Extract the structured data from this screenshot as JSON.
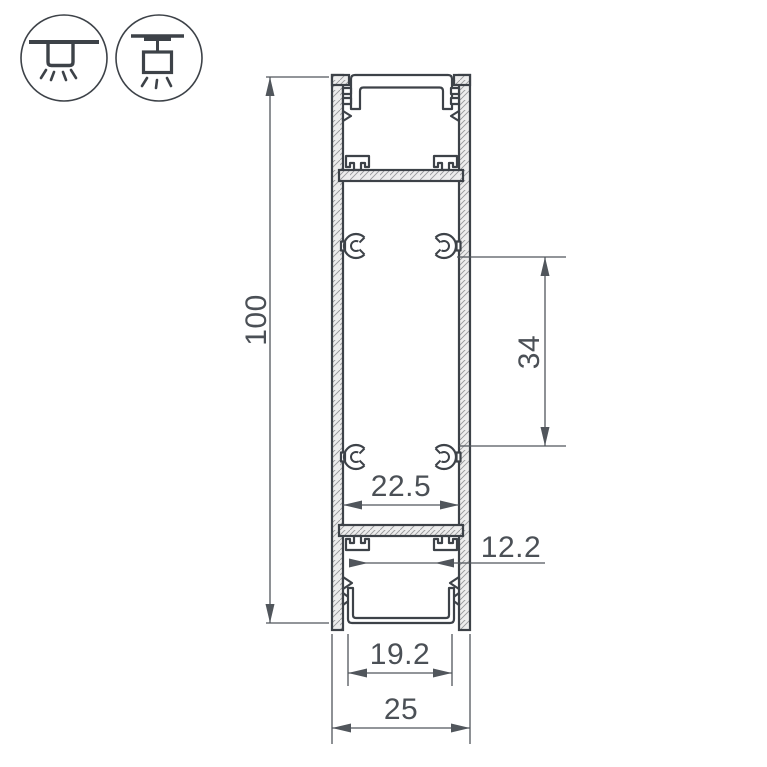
{
  "drawing": {
    "dimensions": {
      "overall_height": "100",
      "boss_spacing": "34",
      "inner_width": "22.5",
      "hook_spacing": "12.2",
      "opening_width": "19.2",
      "overall_width": "25"
    },
    "colors": {
      "line": "#3d4248",
      "dimension": "#51565c",
      "dimension_text": "#4b5056",
      "wall_fill": "#ededed",
      "hatch_line": "#96979a",
      "background": "#ffffff"
    },
    "icons": [
      {
        "name": "recessed-mount-icon"
      },
      {
        "name": "pendant-mount-icon"
      }
    ]
  }
}
